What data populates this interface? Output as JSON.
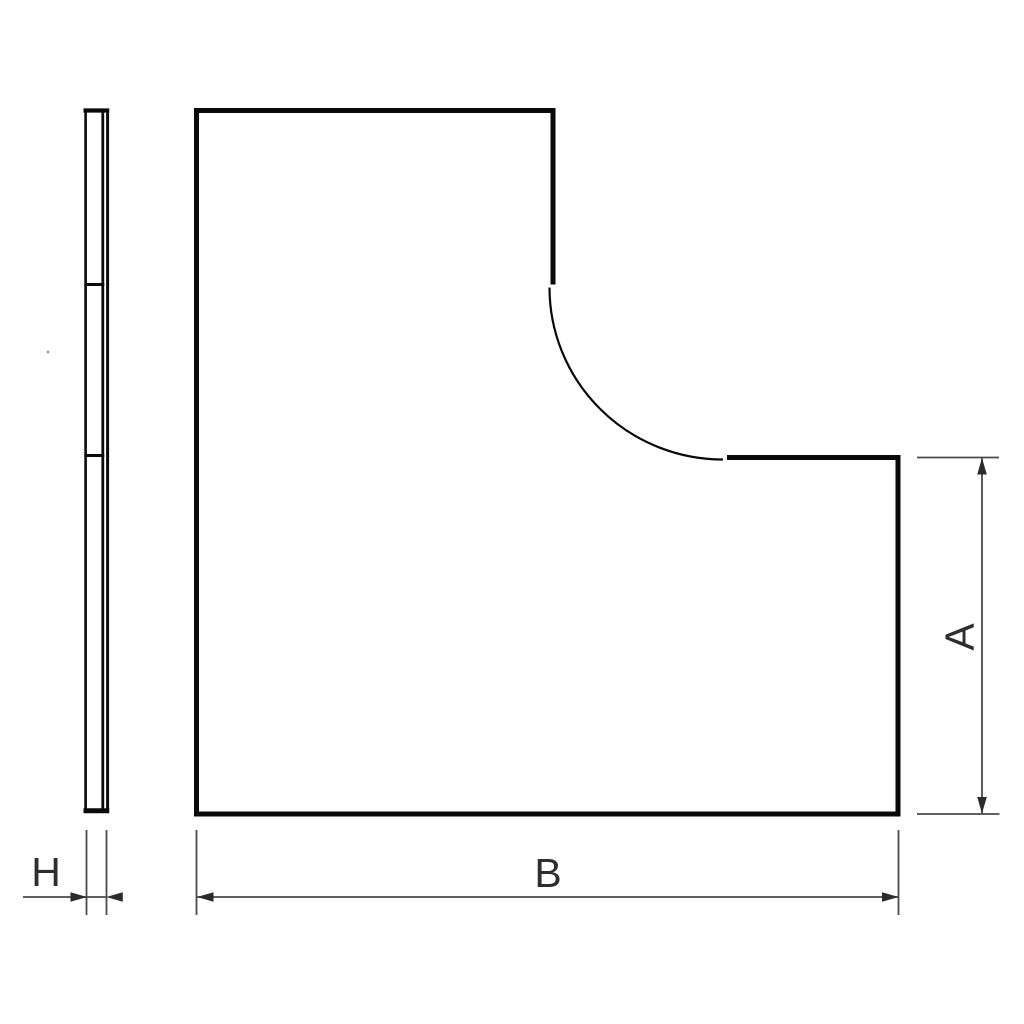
{
  "drawing": {
    "background_color": "#ffffff",
    "outline_color": "#0a0a0a",
    "arc_color": "#0a0a0a",
    "dimension_line_color": "#4a4a4a",
    "arrow_color": "#2b2b2b",
    "label_color": "#2e2e2e",
    "labels": {
      "side_thickness": "H",
      "plan_width": "B",
      "plan_height": "A"
    }
  }
}
